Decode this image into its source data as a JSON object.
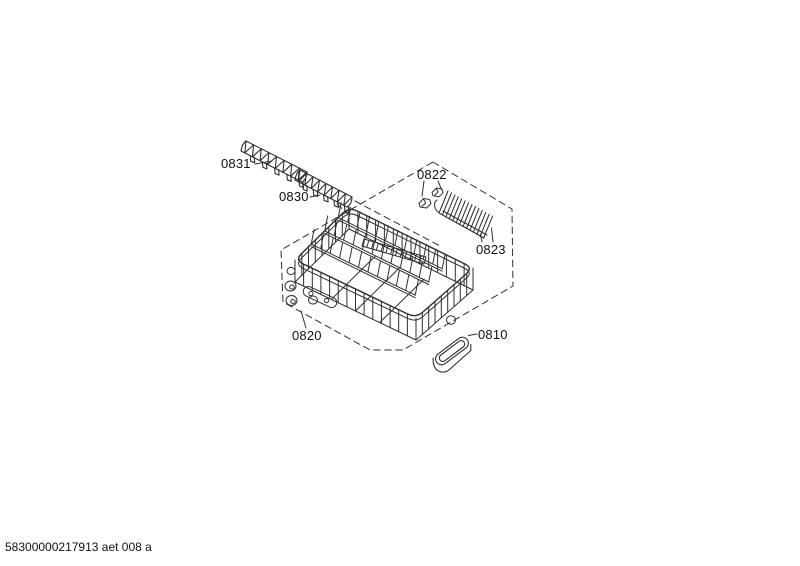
{
  "page": {
    "background": "#ffffff"
  },
  "diagram": {
    "colors": {
      "line": "#2f2f2f",
      "text": "#111111"
    },
    "part_labels": {
      "p0831": "0831",
      "p0830": "0830",
      "p0822": "0822",
      "p0823": "0823",
      "p0820": "0820",
      "p0810": "0810"
    }
  },
  "footer": {
    "code": "58300000217913 aet 008 a"
  }
}
